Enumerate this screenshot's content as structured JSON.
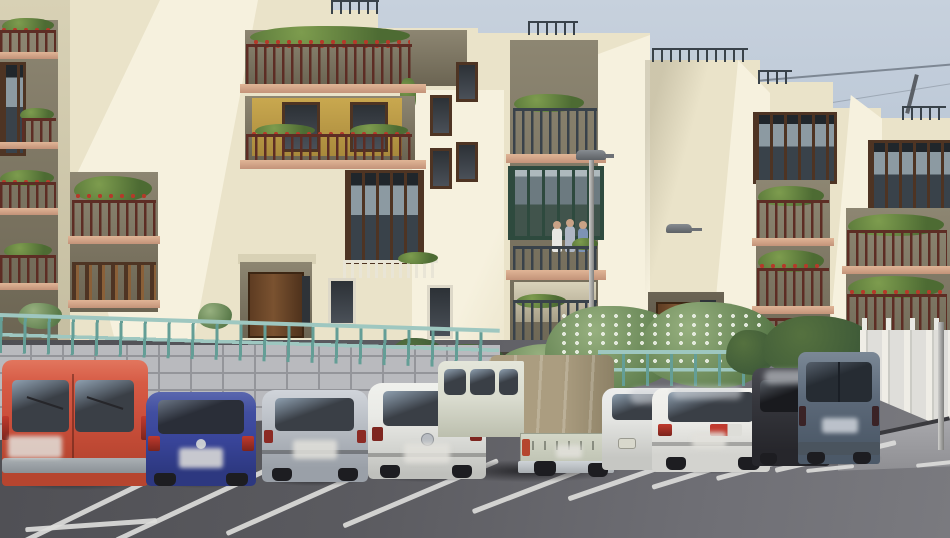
{
  "image": {
    "type": "street-photograph",
    "description": "Daytime street-view photo of cream-coloured multi-storey apartment blocks with a zigzag facade, plant-filled balconies with dark red railings, wooden and green enclosed bay balconies, a teal metal fence on a granite block wall, and a foreground parking lot with nine parked vehicles on dark asphalt with white bay markings.",
    "width": 950,
    "height": 538
  },
  "colors": {
    "sky_top": "#c7d1dd",
    "sky_bottom": "#b4c2d3",
    "wall_lit": "#f6f1de",
    "wall_base": "#eae3c9",
    "wall_shade": "#d8d1b5",
    "wall_deep": "#c4bda0",
    "recess_top": "#8d8672",
    "recess_bot": "#6b6452",
    "salmon": "#e0b596",
    "railing": "#5d2d24",
    "railing_dark": "#39424a",
    "wood": "#4e3423",
    "wood_light": "#8a6038",
    "green_mirador": "#2e4a3e",
    "glass": "#3a3f46",
    "plant": "#4d6b33",
    "plant_light": "#7d9c4e",
    "flower": "#b43a2a",
    "yellow_wall": "#c9a84f",
    "fence_teal": "#9ec7c0",
    "fence_teal_dark": "#649e96",
    "granite": "#b9babe",
    "granite_line": "#94959a",
    "hedge": "#5a7a4a",
    "hedge_light": "#97b07f",
    "shrub_dark": "#3e5a38",
    "white_wall": "#e2e2de",
    "asphalt_dark": "#4f4f54",
    "asphalt_light": "#6f6f75",
    "line_white": "#dcdcda",
    "curb": "#a0a0a5",
    "pole_gray": "#a2a2a0",
    "plinth": "#46433a",
    "van_red": "#cc4f3c",
    "van_red_hi": "#e2765e",
    "car_blue": "#39459a",
    "car_silver": "#b7bcc3",
    "car_white": "#e9eae6",
    "truck_body": "#d9dbce",
    "truck_canvas": "#ab9d80",
    "truck_canvas_dark": "#8d8166",
    "sedan_white": "#ebebe7",
    "car_dark": "#35363c",
    "van_gray": "#5d6a7a",
    "wheel_dark": "#1d1d21",
    "bumper_gray": "#aab0b4",
    "tail_red": "#c03a2e"
  },
  "scene": {
    "sky": {
      "label": "pale overcast-blue sky",
      "power_line": true,
      "rooftop_antenna": true
    },
    "buildings": [
      {
        "id": "left-apartment-block",
        "facade": "cream zigzag with sunlit angled walls",
        "features": [
          "open balconies with dark red railings and flower boxes",
          "yellow recessed balcony wall",
          "brown wooden enclosed balcony",
          "wood-slat balcony",
          "entrance porch with wooden double door",
          "roof parapet railing"
        ]
      },
      {
        "id": "center-tower",
        "features": [
          "dark green glazed bay balcony",
          "balcony with three people",
          "plant-filled balconies",
          "wall-mounted street lamp",
          "roof railing"
        ]
      },
      {
        "id": "right-apartment-block",
        "features": [
          "two brown wooden bay windows (miradores)",
          "stacked recessed balconies full of plants",
          "entrance with wooden door",
          "orange door panel",
          "wall-mounted street lamp",
          "roof railings"
        ]
      }
    ],
    "street_furniture": [
      "wall lamp on center tower",
      "wall lamp on right block",
      "free-standing lamp pole at center",
      "gray pole at right edge"
    ],
    "barriers": [
      "teal-green metal fence on granite block retaining wall (left)",
      "teal fence segment behind bushes (center-right)",
      "white block wall with posts (right)",
      "concrete curb and sidewalk (bottom right)"
    ],
    "vegetation": [
      "balcony pot plants and red flowers throughout",
      "dark hedge at building base",
      "large light-green oleander bush with white flowers",
      "dark shrubs near right entrance",
      "small bushes on left wall top"
    ],
    "parking_lot": {
      "surface": "dark asphalt",
      "markings": "white diagonal parking bay lines",
      "perspective": "bays angle down to the lower left"
    },
    "vehicles": [
      {
        "id": "red-van",
        "type": "panel van",
        "color_name": "salmon red",
        "color": "#cc4f3c",
        "view": "rear",
        "license_plate": "blurred"
      },
      {
        "id": "blue-hatchback",
        "type": "hatchback",
        "color_name": "dark blue",
        "color": "#39459a",
        "view": "rear",
        "license_plate": "blurred"
      },
      {
        "id": "silver-hatchback",
        "type": "hatchback",
        "color_name": "silver",
        "color": "#b7bcc3",
        "view": "rear",
        "license_plate": "blurred"
      },
      {
        "id": "white-hatchback",
        "type": "hatchback with round maker badge",
        "color_name": "white",
        "color": "#e9eae6",
        "view": "rear",
        "license_plate": "blurred"
      },
      {
        "id": "canvas-truck",
        "type": "double-cab light truck with tan canvas cover",
        "color_name": "pale green-white / khaki",
        "color": "#ab9d80",
        "view": "rear three-quarter"
      },
      {
        "id": "white-compact",
        "type": "small car partly hidden",
        "color_name": "white",
        "color": "#e3e4e1",
        "view": "front corner",
        "blur_patch": true
      },
      {
        "id": "white-sedan",
        "type": "sedan",
        "color_name": "white",
        "color": "#ebebe7",
        "view": "rear",
        "blur_patch": true
      },
      {
        "id": "dark-hatchback",
        "type": "hatchback",
        "color_name": "very dark gray",
        "color": "#35363c",
        "view": "rear corner",
        "blur_patch": true
      },
      {
        "id": "gray-blue-van",
        "type": "boxy van",
        "color_name": "gray blue",
        "color": "#5d6a7a",
        "view": "rear",
        "license_plate": "blurred"
      }
    ],
    "people": {
      "count": 3,
      "location": "upper balcony of center tower"
    }
  }
}
